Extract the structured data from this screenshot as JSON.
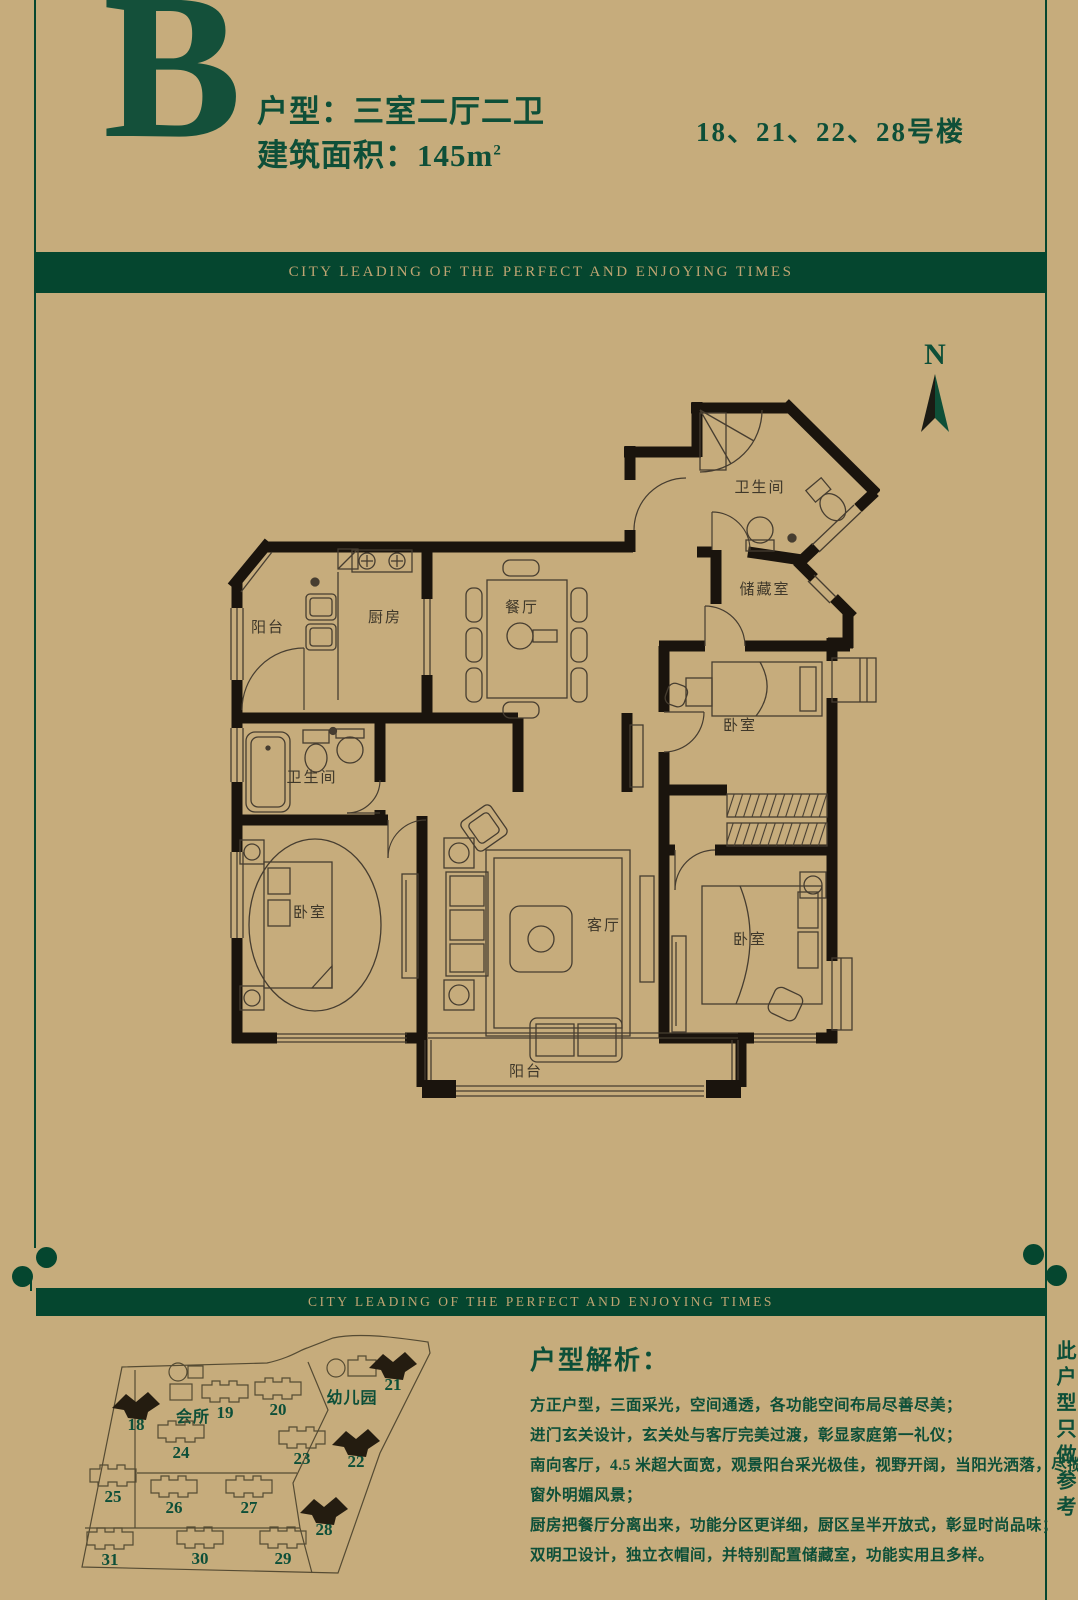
{
  "header": {
    "unit_letter": "B",
    "unit_type_label": "户型：三室二厅二卫",
    "area_label": "建筑面积：145m",
    "area_exponent": "2",
    "buildings_label": "18、21、22、28号楼"
  },
  "banners": {
    "top": "CITY LEADING OF THE PERFECT AND ENJOYING TIMES",
    "bottom": "CITY LEADING OF THE PERFECT AND ENJOYING TIMES"
  },
  "compass": {
    "label": "N"
  },
  "floorplan": {
    "rooms": {
      "bath_top": "卫生间",
      "storage": "储藏室",
      "balcony_top": "阳台",
      "kitchen": "厨房",
      "dining": "餐厅",
      "bath_left": "卫生间",
      "bedroom_left": "卧室",
      "living": "客厅",
      "bedroom_right_top": "卧室",
      "bedroom_right_bottom": "卧室",
      "balcony_bottom": "阳台"
    }
  },
  "sitemap": {
    "labels": {
      "clubhouse": "会所",
      "kindergarten": "幼儿园"
    },
    "buildings": [
      {
        "label": "18",
        "highlighted": true,
        "x": 76,
        "y": 76
      },
      {
        "label": "19",
        "highlighted": false,
        "x": 165,
        "y": 64
      },
      {
        "label": "20",
        "highlighted": false,
        "x": 218,
        "y": 61
      },
      {
        "label": "21",
        "highlighted": true,
        "x": 333,
        "y": 36
      },
      {
        "label": "24",
        "highlighted": false,
        "x": 121,
        "y": 104
      },
      {
        "label": "23",
        "highlighted": false,
        "x": 242,
        "y": 110
      },
      {
        "label": "22",
        "highlighted": true,
        "x": 296,
        "y": 113
      },
      {
        "label": "25",
        "highlighted": false,
        "x": 53,
        "y": 148
      },
      {
        "label": "26",
        "highlighted": false,
        "x": 114,
        "y": 159
      },
      {
        "label": "27",
        "highlighted": false,
        "x": 189,
        "y": 159
      },
      {
        "label": "28",
        "highlighted": true,
        "x": 264,
        "y": 181
      },
      {
        "label": "31",
        "highlighted": false,
        "x": 50,
        "y": 211
      },
      {
        "label": "30",
        "highlighted": false,
        "x": 140,
        "y": 210
      },
      {
        "label": "29",
        "highlighted": false,
        "x": 223,
        "y": 210
      }
    ]
  },
  "analysis": {
    "title": "户型解析：",
    "lines": [
      "方正户型，三面采光，空间通透，各功能空间布局尽善尽美；",
      "进门玄关设计，玄关处与客厅完美过渡，彰显家庭第一礼仪；",
      "南向客厅，4.5 米超大面宽，观景阳台采光极佳，视野开阔，当阳光洒落，尽揽",
      "窗外明媚风景；",
      "厨房把餐厅分离出来，功能分区更详细，厨区呈半开放式，彰显时尚品味；",
      "双明卫设计，独立衣帽间，并特别配置储藏室，功能实用且多样。"
    ]
  },
  "side_note": "此户型只做参考",
  "colors": {
    "background": "#c6ac7c",
    "green_dark": "#05462f",
    "green_text": "#0e4f38",
    "wall": "#1a140d",
    "thin_line": "#463d30",
    "banner_text": "#bfa472"
  }
}
